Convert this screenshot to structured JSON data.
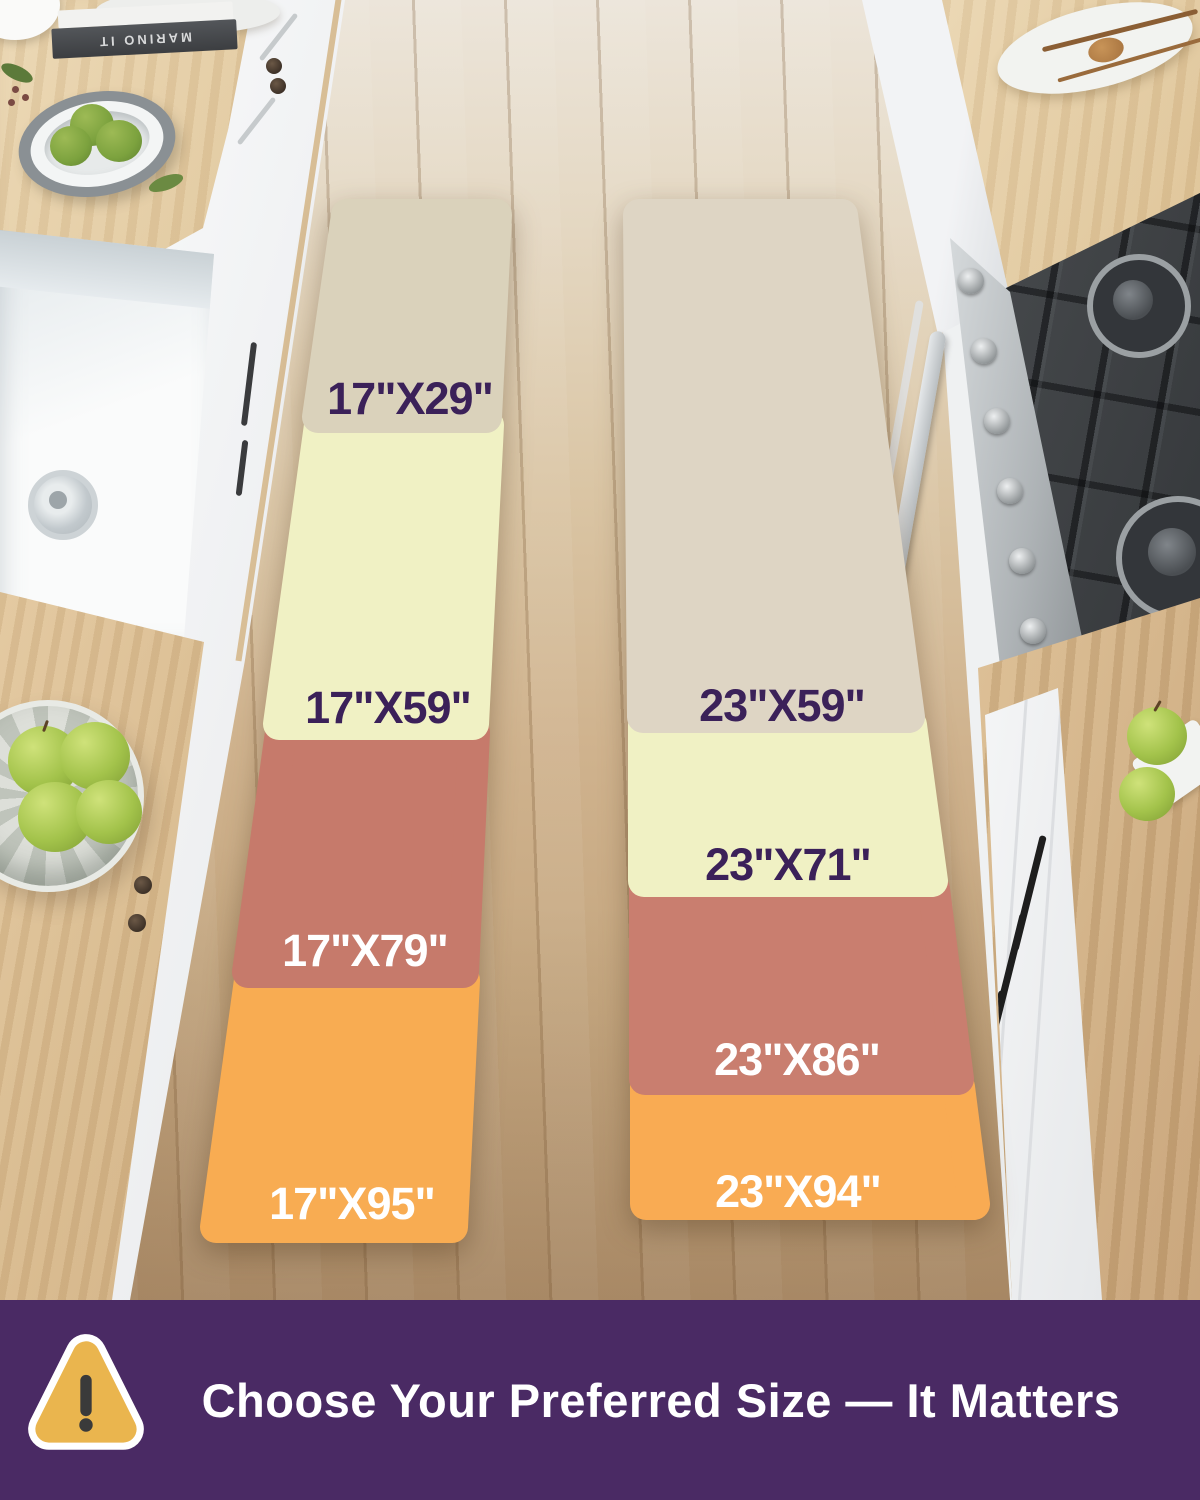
{
  "size_chart": {
    "left_runner": {
      "sections": [
        {
          "label": "17\"X29\"",
          "color": "#DAD2BB",
          "label_color": "#3B2159"
        },
        {
          "label": "17\"X59\"",
          "color": "#F0F1C4",
          "label_color": "#3B2159"
        },
        {
          "label": "17\"X79\"",
          "color": "#C67A6B",
          "label_color": "#FFFFFF"
        },
        {
          "label": "17\"X95\"",
          "color": "#F8AC52",
          "label_color": "#FFFFFF"
        }
      ]
    },
    "right_runner": {
      "sections": [
        {
          "label": "23\"X59\"",
          "color": "#DED5C4",
          "label_color": "#3B2159"
        },
        {
          "label": "23\"X71\"",
          "color": "#F0F1C4",
          "label_color": "#3B2159"
        },
        {
          "label": "23\"X86\"",
          "color": "#C97E6F",
          "label_color": "#FFFFFF"
        },
        {
          "label": "23\"X94\"",
          "color": "#F9AB53",
          "label_color": "#FFFFFF"
        }
      ]
    }
  },
  "banner": {
    "text": "Choose Your Preferred Size — It Matters",
    "background": "#4A2A64",
    "text_color": "#FFFFFF",
    "warning_icon": {
      "fill": "#EAB54E",
      "border": "#FFFFFF",
      "glyph_color": "#3A3A3A"
    }
  },
  "scene": {
    "book_spine_text": "MARINO IT"
  }
}
